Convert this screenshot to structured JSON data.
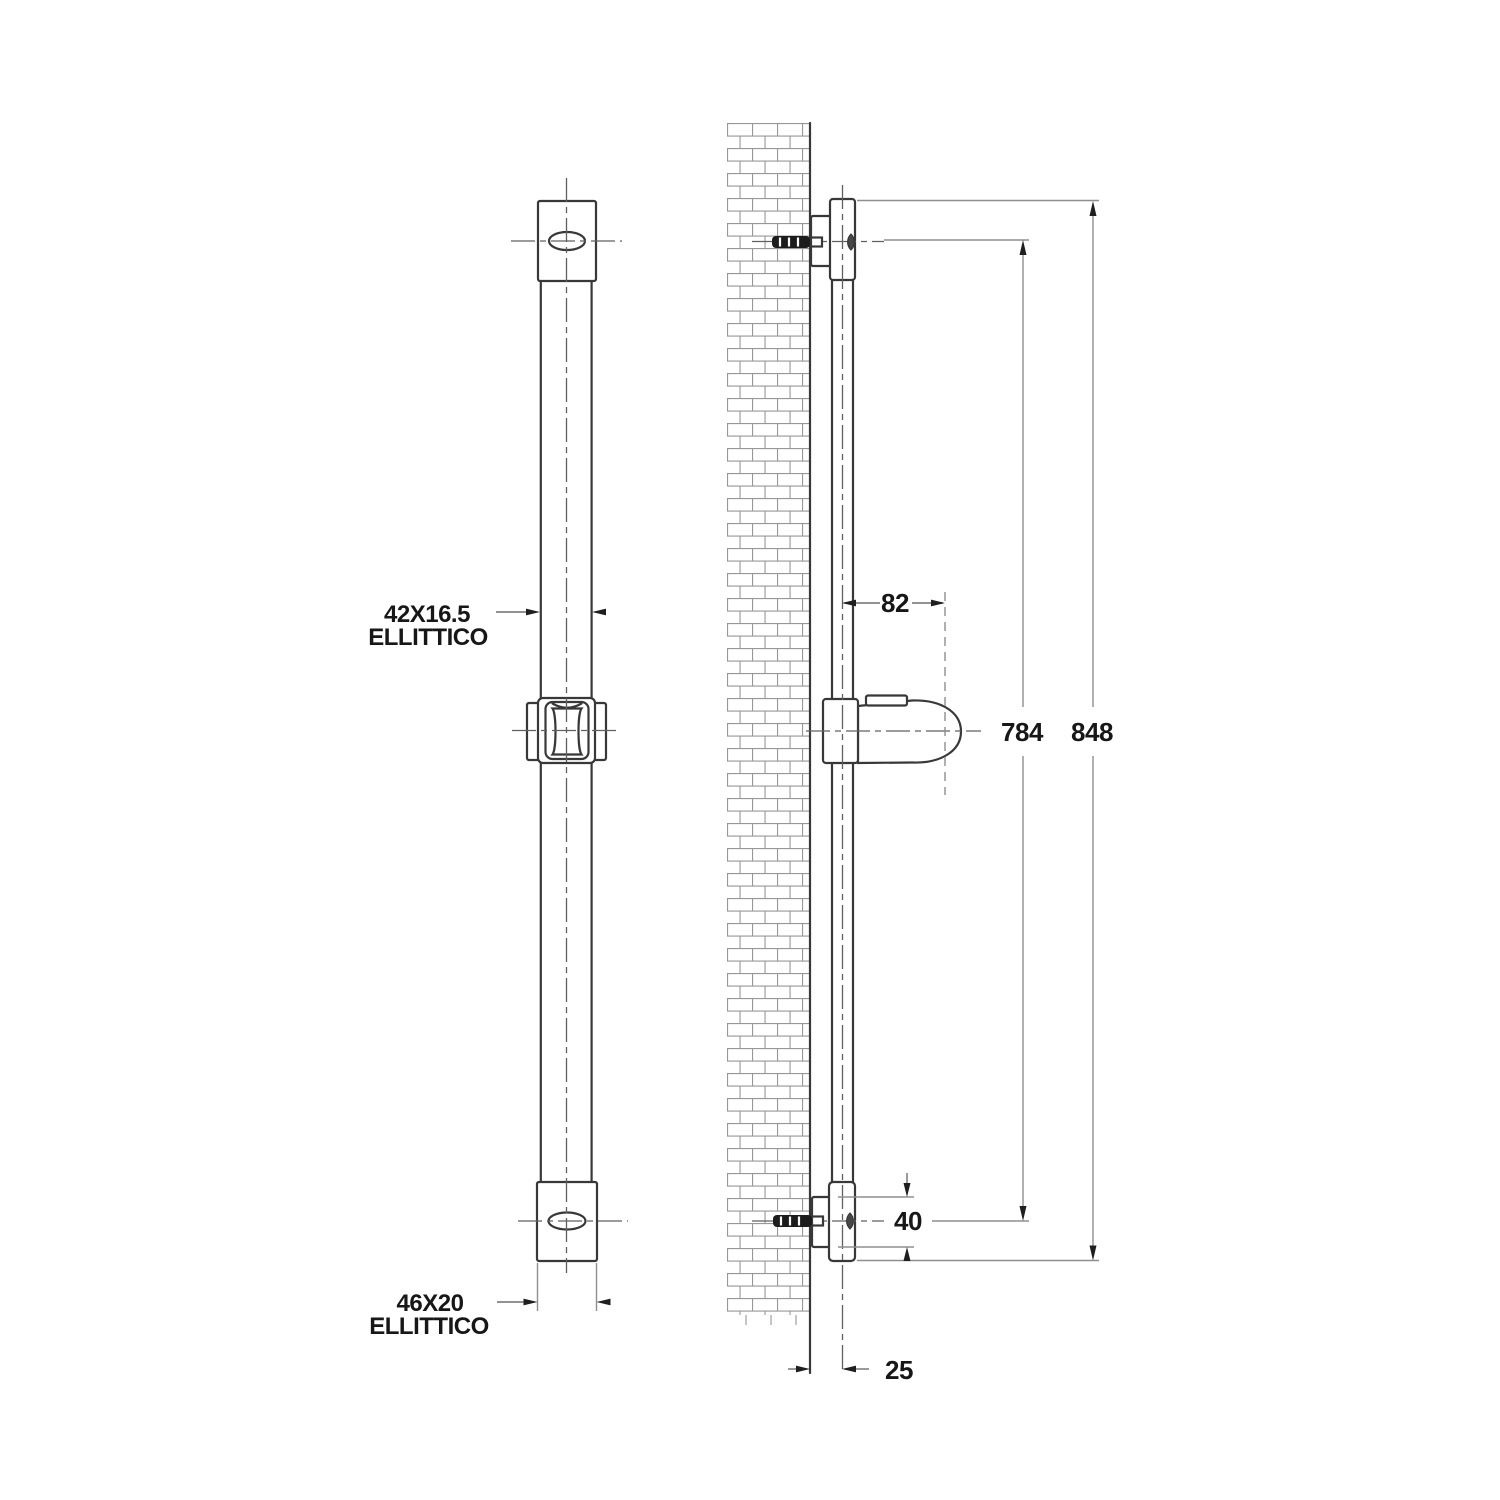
{
  "drawing": {
    "title": "Shower slide rail dimensional drawing, front and side view",
    "annotations": {
      "upper": {
        "size": "42X16.5",
        "shape": "ELLITTICO"
      },
      "lower": {
        "size": "46X20",
        "shape": "ELLITTICO"
      }
    },
    "dimensions": {
      "holder_offset": "82",
      "fixing_centres": "784",
      "overall_length": "848",
      "bracket_height": "40",
      "wall_offset": "25"
    },
    "colors": {
      "outline": "#383838",
      "dimension_line": "#8f8f8f",
      "text": "#171717",
      "brick": "#979797",
      "background": "#ffffff"
    }
  }
}
